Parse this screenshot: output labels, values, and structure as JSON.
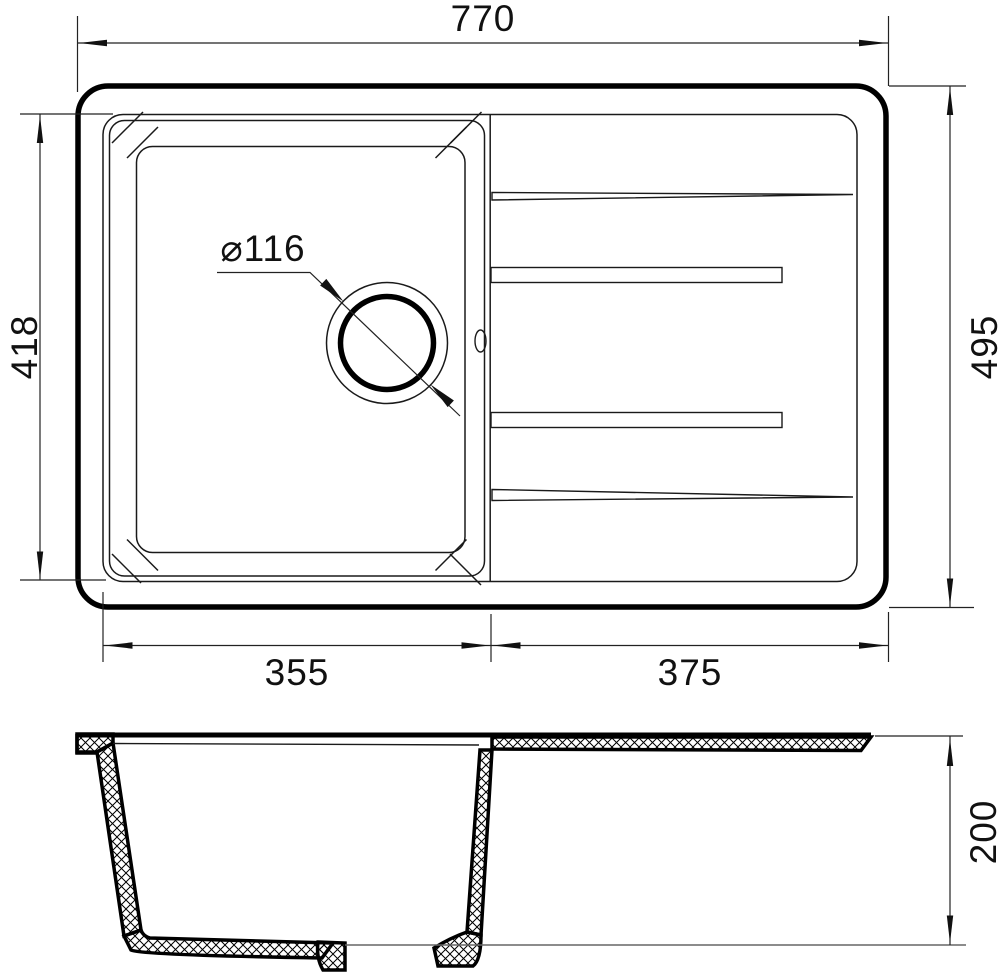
{
  "drawing": {
    "colors": {
      "line": "#000000",
      "dim_line": "#222222",
      "ground_line": "#666666",
      "background": "#ffffff"
    },
    "dims": {
      "overall_width": "770",
      "bowl_depth": "418",
      "overall_depth": "495",
      "bowl_width": "355",
      "drainboard_width": "375",
      "drain_diameter": "⌀116",
      "section_height": "200"
    }
  }
}
